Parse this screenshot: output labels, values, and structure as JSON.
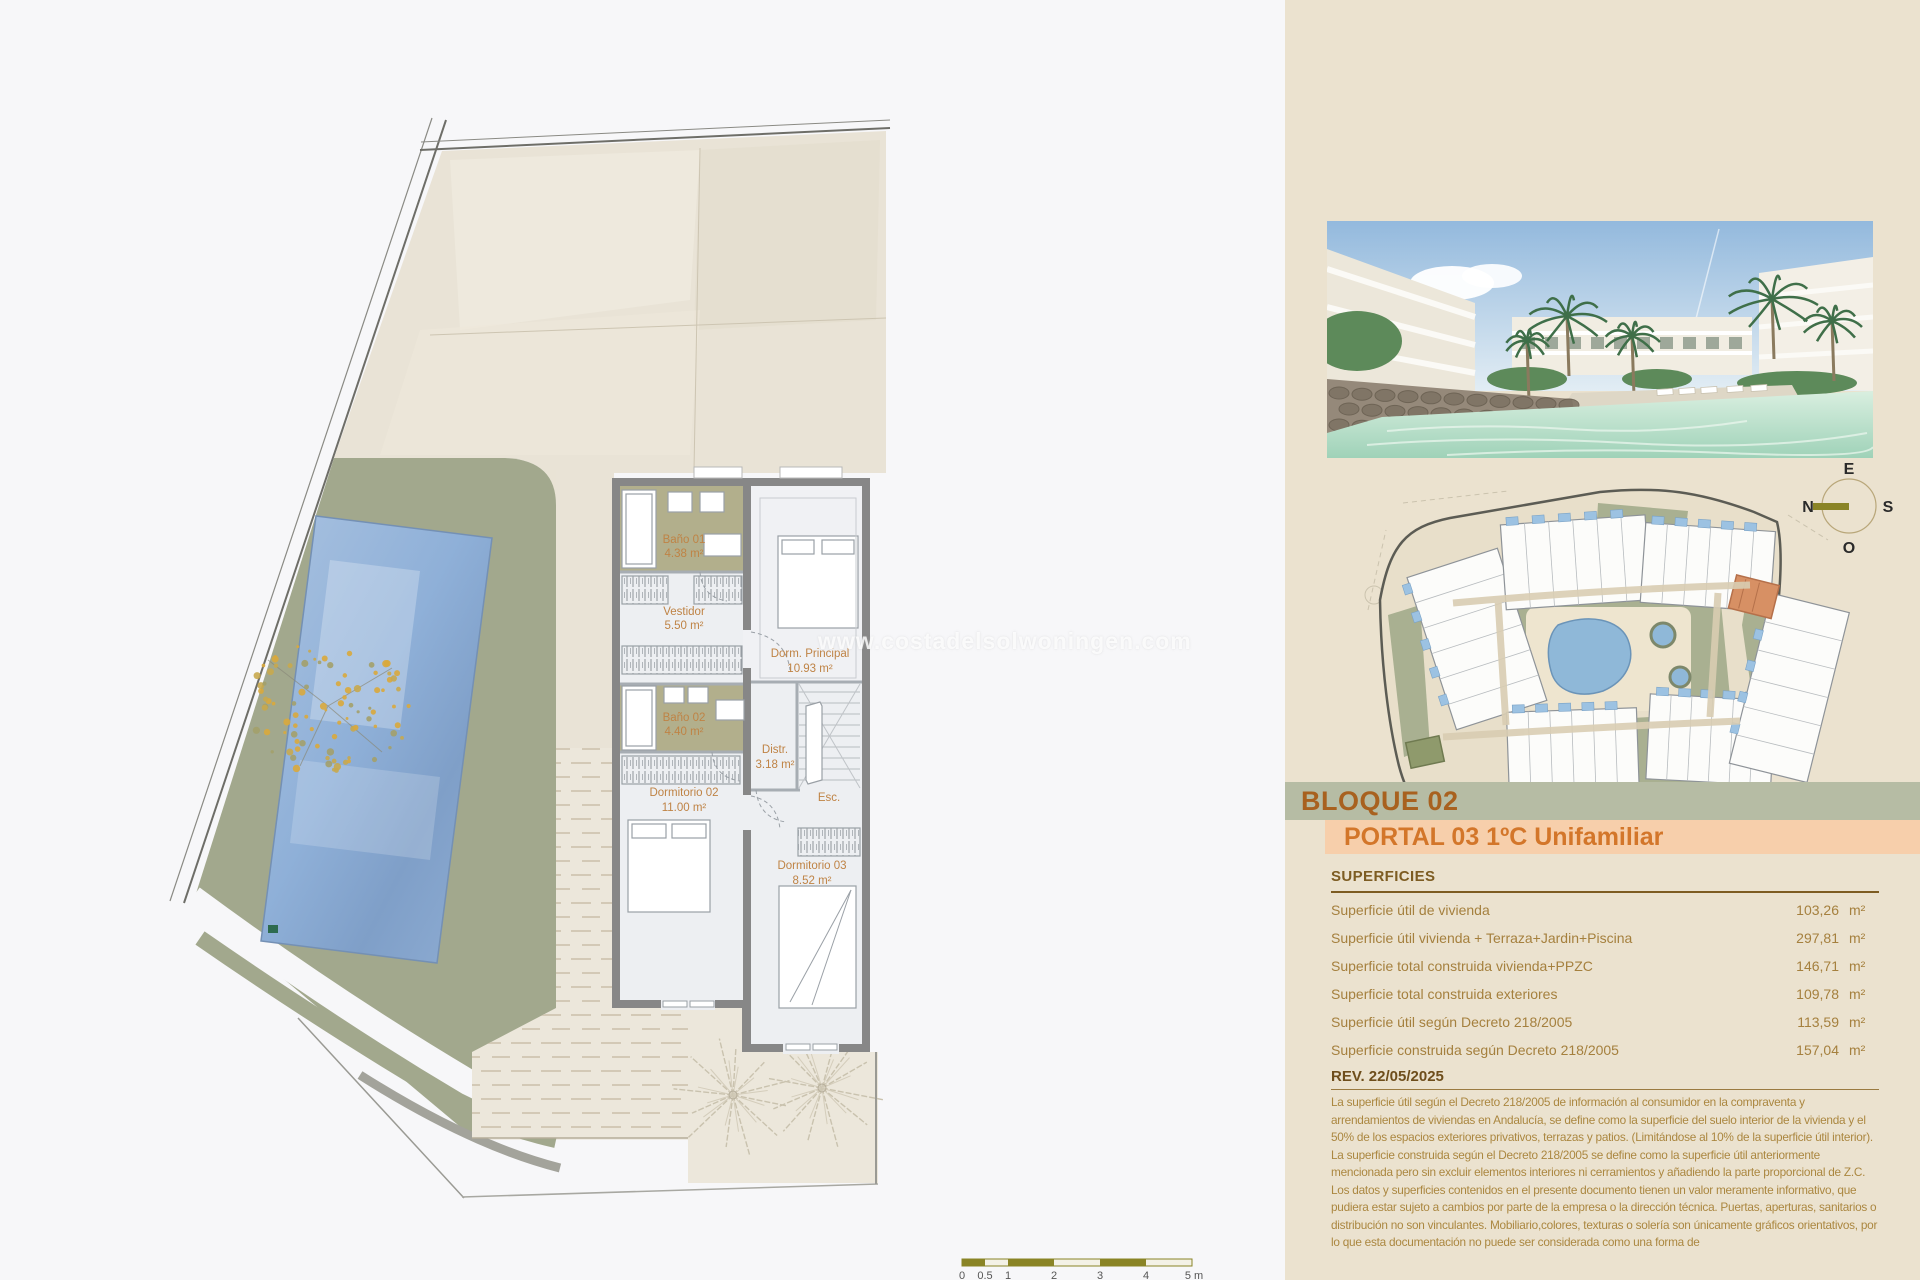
{
  "watermark": "www.costadelsolwoningen.com",
  "plan": {
    "rooms": [
      {
        "name": "Baño 01",
        "area": "4.38 m²"
      },
      {
        "name": "Vestidor",
        "area": "5.50 m²"
      },
      {
        "name": "Dorm. Principal",
        "area": "10.93 m²"
      },
      {
        "name": "Baño 02",
        "area": "4.40 m²"
      },
      {
        "name": "Distr.",
        "area": "3.18 m²"
      },
      {
        "name": "Dormitorio 02",
        "area": "11.00 m²"
      },
      {
        "name": "Esc.",
        "area": ""
      },
      {
        "name": "Dormitorio 03",
        "area": "8.52 m²"
      }
    ],
    "scalebar": {
      "labels": [
        "0",
        "0.5",
        "1",
        "2",
        "3",
        "4",
        "5 m"
      ]
    }
  },
  "panel": {
    "bloque_title": "BLOQUE 02",
    "portal_title": "PORTAL 03 1ºC Unifamiliar",
    "compass": {
      "top": "E",
      "right": "S",
      "bottom": "O",
      "left": "N"
    },
    "superficies": {
      "heading": "SUPERFICIES",
      "unit": "m²",
      "rows": [
        {
          "label": "Superficie útil de vivienda",
          "value": "103,26"
        },
        {
          "label": "Superficie útil vivienda + Terraza+Jardin+Piscina",
          "value": "297,81"
        },
        {
          "label": "Superficie total construida vivienda+PPZC",
          "value": "146,71"
        },
        {
          "label": "Superficie total construida exteriores",
          "value": "109,78"
        },
        {
          "label": "Superficie útil según Decreto 218/2005",
          "value": "113,59"
        },
        {
          "label": "Superficie construida según Decreto 218/2005",
          "value": "157,04"
        }
      ]
    },
    "revision": {
      "heading": "REV. 22/05/2025",
      "p1": "La superficie útil según el Decreto 218/2005 de información al consumidor en la compraventa y arrendamientos de viviendas en Andalucía, se define como la superficie del suelo interior de la vivienda y el 50% de los espacios exteriores privativos, terrazas y patios. (Limitándose al 10% de la superficie útil interior).",
      "p2": "La superficie construida según el Decreto 218/2005 se define como la superficie útil anteriormente mencionada pero sin excluir elementos interiores ni cerramientos y añadiendo la parte proporcional de Z.C.",
      "p3": "Los datos y superficies contenidos en el presente documento tienen un valor meramente informativo, que pudiera estar sujeto a cambios por parte de la empresa o la dirección técnica. Puertas, aperturas, sanitarios o distribución no son vinculantes. Mobiliario,colores, texturas o solería son únicamente gráficos orientativos, por lo que esta documentación no puede ser considerada como una forma de"
    }
  },
  "colors": {
    "panel_bg": "#ebe2cf",
    "band_sage": "#b6bca4",
    "band_peach": "#f7cfab",
    "accent_orange": "#d3762a",
    "accent_brown": "#a8611f",
    "garden_green": "#a2a88d",
    "pool_blue": "#8fb0d8",
    "bath_olive": "#b2af8c",
    "wall_gray": "#878787",
    "label_orange": "#bf8345",
    "scalebar_olive": "#8a8426"
  }
}
